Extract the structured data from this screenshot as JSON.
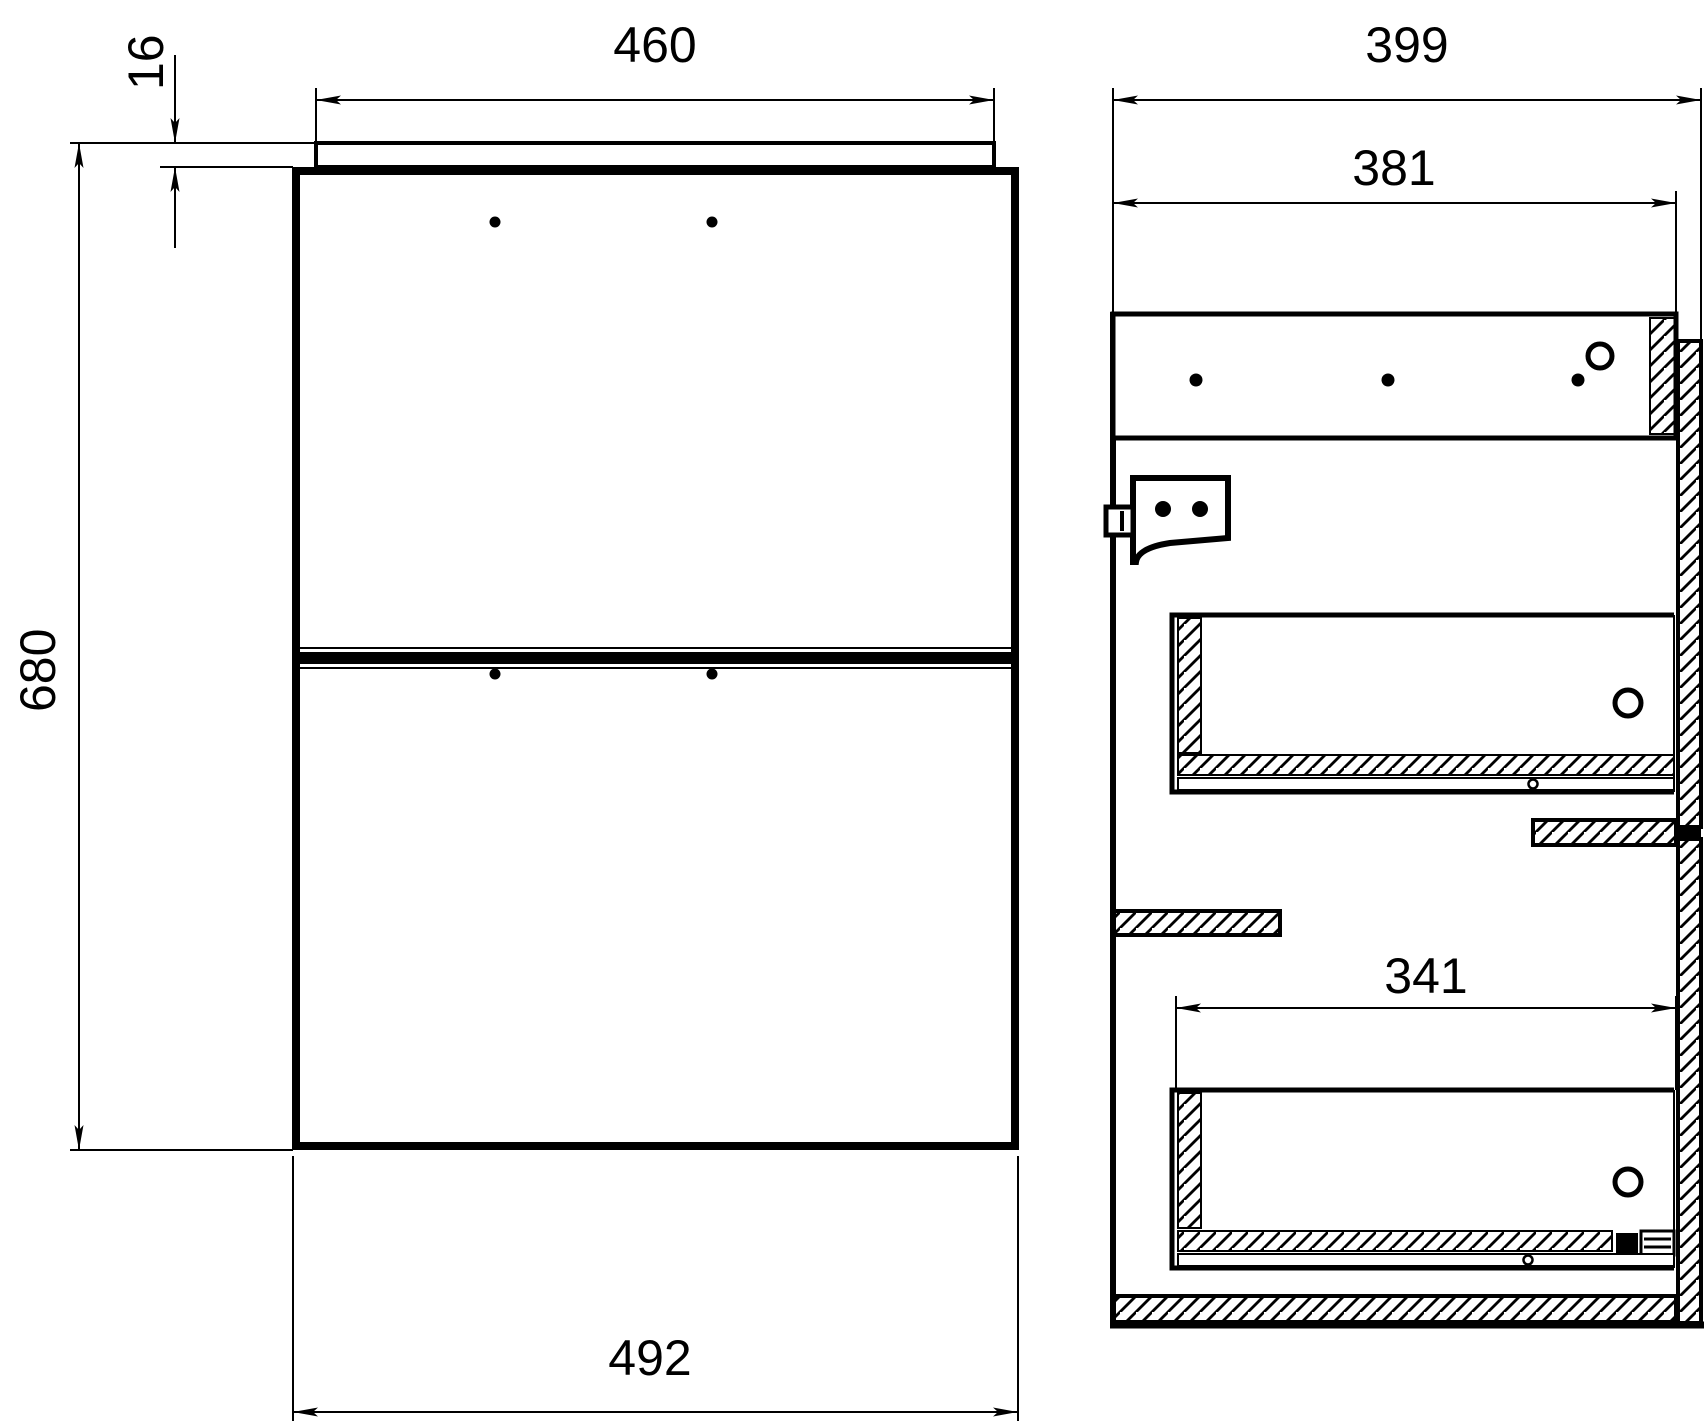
{
  "drawing": {
    "colors": {
      "line": "#000000",
      "background": "#ffffff"
    },
    "front_view": {
      "top_panel_width": "460",
      "top_panel_thickness": "16",
      "total_height": "680",
      "body_width": "492"
    },
    "side_view": {
      "total_depth": "399",
      "body_depth": "381",
      "drawer_depth": "341"
    }
  }
}
